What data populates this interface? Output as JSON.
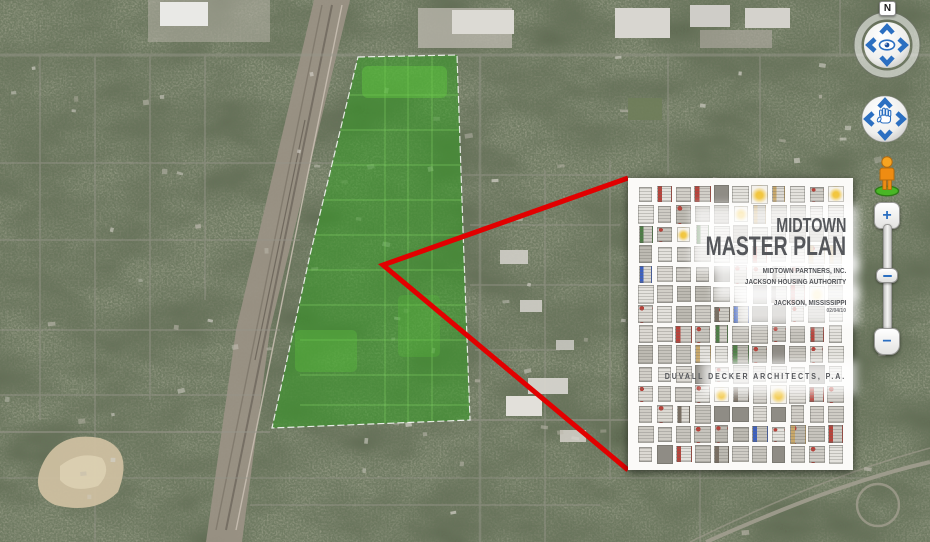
{
  "overlay_card": {
    "title_line1": "MIDTOWN",
    "title_line2": "MASTER PLAN",
    "clients": [
      "MIDTOWN PARTNERS, INC.",
      "JACKSON HOUSING AUTHORITY"
    ],
    "location": "JACKSON, MISSISSIPPI",
    "date": "02/04/10",
    "firm": "DUVALL DECKER ARCHITECTS, P.A."
  },
  "navigation": {
    "north_label": "N",
    "zoom_in_label": "+",
    "zoom_out_label": "−"
  },
  "colors": {
    "highlight_polygon_green": "#2f9e1e",
    "callout_line_red": "#e20000",
    "control_blue": "#2b6fc1",
    "pegman_orange": "#f59c1b",
    "pegman_base_green": "#3fae29",
    "doc_title_gray": "#55575b"
  },
  "thumbnail_grid": {
    "rows": 14,
    "cols": 11,
    "base_colors": [
      "#dcd9d3",
      "#d2cfc8",
      "#c7c4bd",
      "#bdbab2",
      "#e4e2dd",
      "#cfccc5"
    ],
    "solid_dark": "#8f8c85",
    "accent_colors": [
      "#b8423a",
      "#3b5fc0",
      "#4d7d45",
      "#c9a86a",
      "#7a6f63"
    ],
    "splat_color": "#f2c63e"
  }
}
